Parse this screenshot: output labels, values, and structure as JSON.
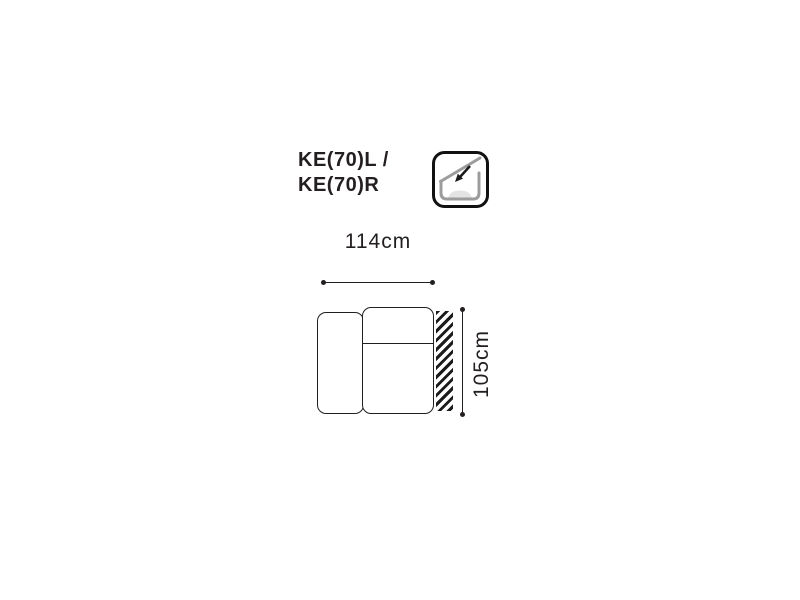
{
  "page": {
    "background_color": "#ffffff",
    "line_color": "#231f20"
  },
  "product": {
    "title_line1": "KE(70)L /",
    "title_line2": "KE(70)R"
  },
  "feature_icon": {
    "name": "reclining-backrest-icon",
    "border_color": "#111111",
    "frame_gray": "#9c9c9c",
    "cushion_gray": "#e3e3e3",
    "arrow_color": "#1a1a1a"
  },
  "dimensions": {
    "width_label": "114cm",
    "height_label": "105cm"
  }
}
